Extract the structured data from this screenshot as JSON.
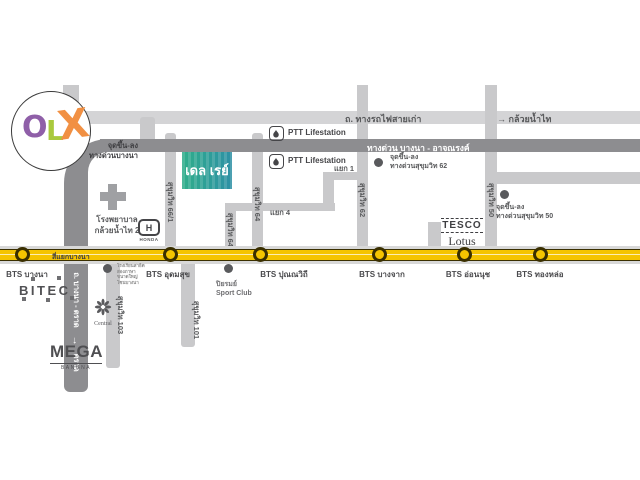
{
  "watermark": {
    "o": "O",
    "l": "L",
    "x": "X"
  },
  "top": {
    "railway_road": "ถ. ทางรถไฟสายเก่า",
    "kluaynamthai": "→ กล้วยน้ำไท",
    "expressway": "ทางด่วน บางนา - อาจณรงค์"
  },
  "ramps": {
    "bangna": {
      "line1": "จุดขึ้น-ลง",
      "line2": "ทางด่วนบางนา"
    },
    "s62": {
      "line1": "จุดขึ้น-ลง",
      "line2": "ทางด่วนสุขุมวิท 62"
    },
    "s50": {
      "line1": "จุดขึ้น-ลง",
      "line2": "ทางด่วนสุขุมวิท 50"
    }
  },
  "junctions": {
    "yaek1": "แยก 1",
    "yaek4": "แยก 4",
    "bangna_intersection": "สี่แยกบางนา"
  },
  "sois": {
    "s66_1": "สุขุมวิท 66/1",
    "s64": "สุขุมวิท 64",
    "s64_1": "สุขุมวิท 64/1",
    "s62": "สุขุมวิท 62",
    "s50": "สุขุมวิท 50",
    "s101": "สุขุมวิท 101",
    "s103": "สุขุมวิท 103"
  },
  "bangna_trat": {
    "name": "ถ. บางนา - ตราด",
    "arrow": "→",
    "direction": "ตราด"
  },
  "project": {
    "name": "เดล เรย์"
  },
  "stations": [
    {
      "label": "BTS บางนา"
    },
    {
      "label": "BTS อุดมสุข"
    },
    {
      "label": "BTS ปุณณวิถี"
    },
    {
      "label": "BTS บางจาก"
    },
    {
      "label": "BTS อ่อนนุช"
    },
    {
      "label": "BTS ทองหล่อ"
    }
  ],
  "landmarks": {
    "ptt1": "PTT Lifestation",
    "ptt2": "PTT Lifestation",
    "hospital": {
      "line1": "โรงพยาบาล",
      "line2": "กล้วยน้ำไท 2"
    },
    "honda": {
      "letter": "H",
      "name": "HONDA"
    },
    "tesco": {
      "line1": "TESCO",
      "line2": "Lotus"
    },
    "bitec": "BITEC",
    "mega": {
      "name": "MEGA",
      "sub": "BANGNA"
    },
    "central": "Central",
    "sportclub": {
      "line1": "ปิยรมย์",
      "line2": "Sport Club"
    },
    "note": {
      "line1": "โรงเรียนสาธิต",
      "line2": "สองภาษา",
      "line3": "ขนาดใหญ่",
      "line4": "โซนบางนา"
    }
  },
  "colors": {
    "road_yellow": "#f5c400",
    "road_gray": "#c9c9cb",
    "road_dark": "#8d8d90",
    "project_teal": "#2fae8a",
    "olx_o": "#8f5fa8",
    "olx_l": "#a9c93d",
    "olx_x": "#f19043"
  }
}
